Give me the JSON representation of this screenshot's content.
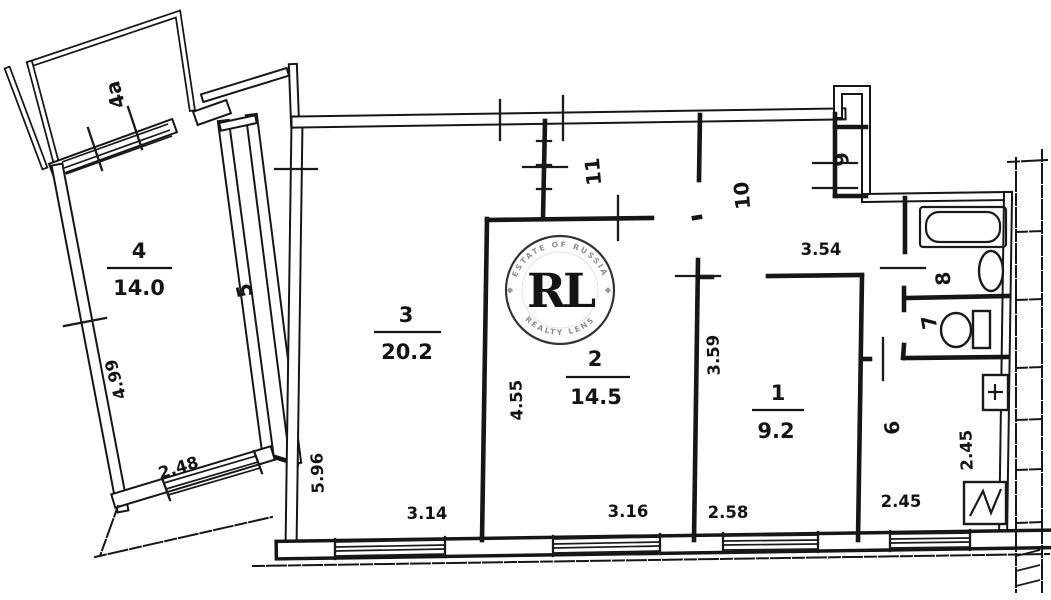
{
  "plan": {
    "kind": "apartment-floor-plan-scan"
  },
  "rooms": {
    "r1": {
      "number": "1",
      "area": "9.2",
      "width": "2.58",
      "depth": "3.59"
    },
    "r2": {
      "number": "2",
      "area": "14.5",
      "width": "3.16",
      "depth": "4.55"
    },
    "r3": {
      "number": "3",
      "area": "20.2",
      "width": "3.14",
      "depth": "5.96"
    },
    "r4": {
      "number": "4",
      "area": "14.0",
      "width": "2.48",
      "depth": "4.99"
    },
    "r4a": {
      "number": "4а"
    },
    "r5": {
      "number": "5"
    },
    "r6": {
      "number": "6",
      "width": "2.45",
      "depth": "2.45"
    },
    "r7": {
      "number": "7"
    },
    "r8": {
      "number": "8"
    },
    "r9": {
      "number": "9"
    },
    "r10": {
      "number": "10",
      "length": "3.54"
    },
    "r11": {
      "number": "11"
    }
  },
  "watermark": {
    "initials": "RL",
    "arc_top": "ESTATE OF RUSSIA",
    "arc_bottom": "REALTY LENS",
    "gold_color": "#c09a3e",
    "ring_color": "#333333"
  }
}
